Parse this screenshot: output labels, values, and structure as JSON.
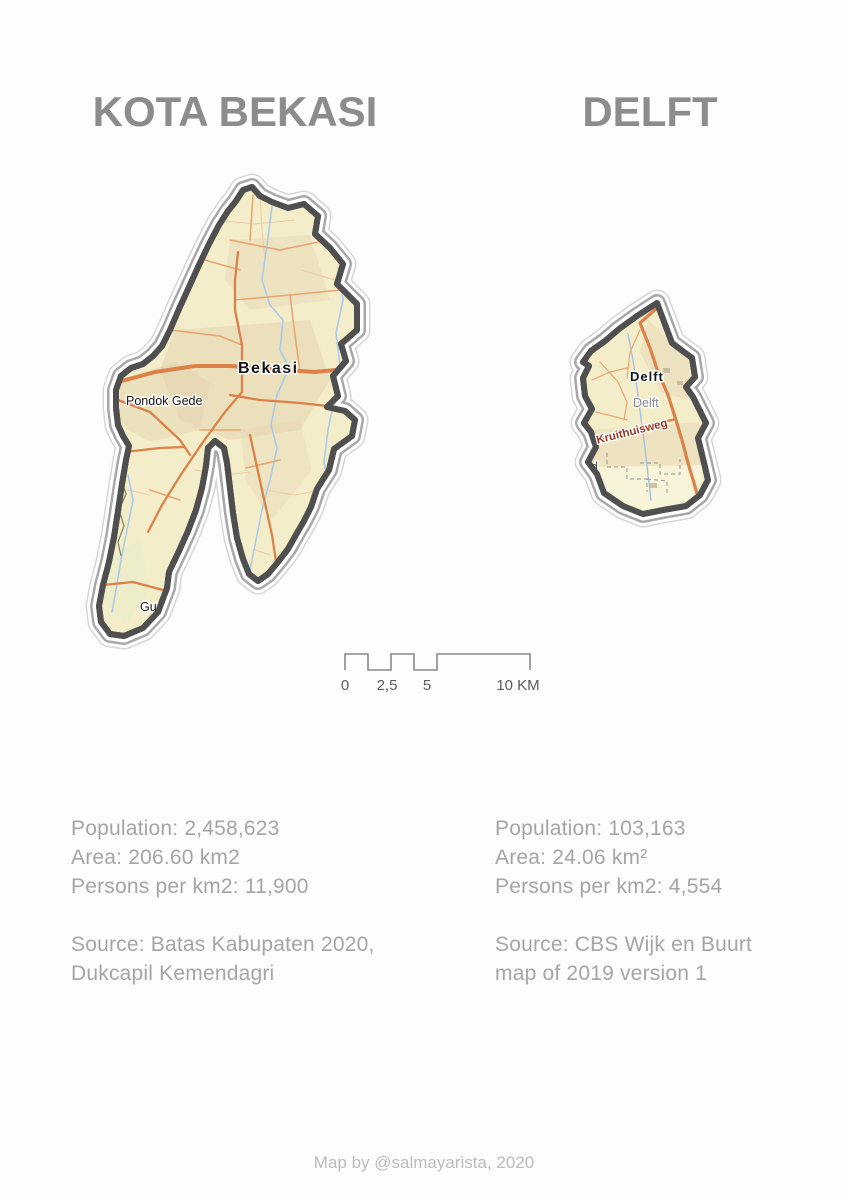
{
  "titles": {
    "bekasi": "KOTA BEKASI",
    "delft": "DELFT"
  },
  "bekasi_map": {
    "city_label": "Bekasi",
    "district_label": "Pondok Gede",
    "clipped_label": "Gunu"
  },
  "delft_map": {
    "city_label": "Delft",
    "area_label": "Delft",
    "road_label": "Kruithuisweg",
    "clipped_label": "d"
  },
  "scalebar": {
    "tick0": "0",
    "tick1": "2,5",
    "tick2": "5",
    "tick3": "10 KM"
  },
  "stats_bekasi": {
    "population": "Population: 2,458,623",
    "area": "Area: 206.60 km2",
    "density": "Persons per km2: 11,900",
    "source1": "Source: Batas Kabupaten 2020,",
    "source2": "Dukcapil Kemendagri"
  },
  "stats_delft": {
    "population": "Population: 103,163",
    "area": "Area: 24.06 km²",
    "density": "Persons per km2: 4,554",
    "source1": "Source: CBS Wijk en Buurt",
    "source2": "map of 2019 version 1"
  },
  "footer": {
    "credit": "Map by @salmayarista, 2020"
  },
  "colors": {
    "page-bg": "#fdfdfd",
    "title-gray": "#8c8c8c",
    "stats-gray": "#a5a5a5",
    "footer-gray": "#bcbcbc",
    "map-fill": "#f4edca",
    "map-patch": "#e3d2ae",
    "road-major": "#dc8149",
    "road-minor": "#eaa670",
    "road-thin": "#f0cba6",
    "water": "#a9cbe9",
    "border-dark": "#4f4f4f",
    "ring-gray": "#a8a8a8",
    "ring-light": "#d6d6d6",
    "label-dark": "#141414",
    "label-gray": "#8a8a8a",
    "road-label": "#9a3a22",
    "scalebar-line": "#8a8a8a",
    "scalebar-text": "#5c5c5c"
  }
}
